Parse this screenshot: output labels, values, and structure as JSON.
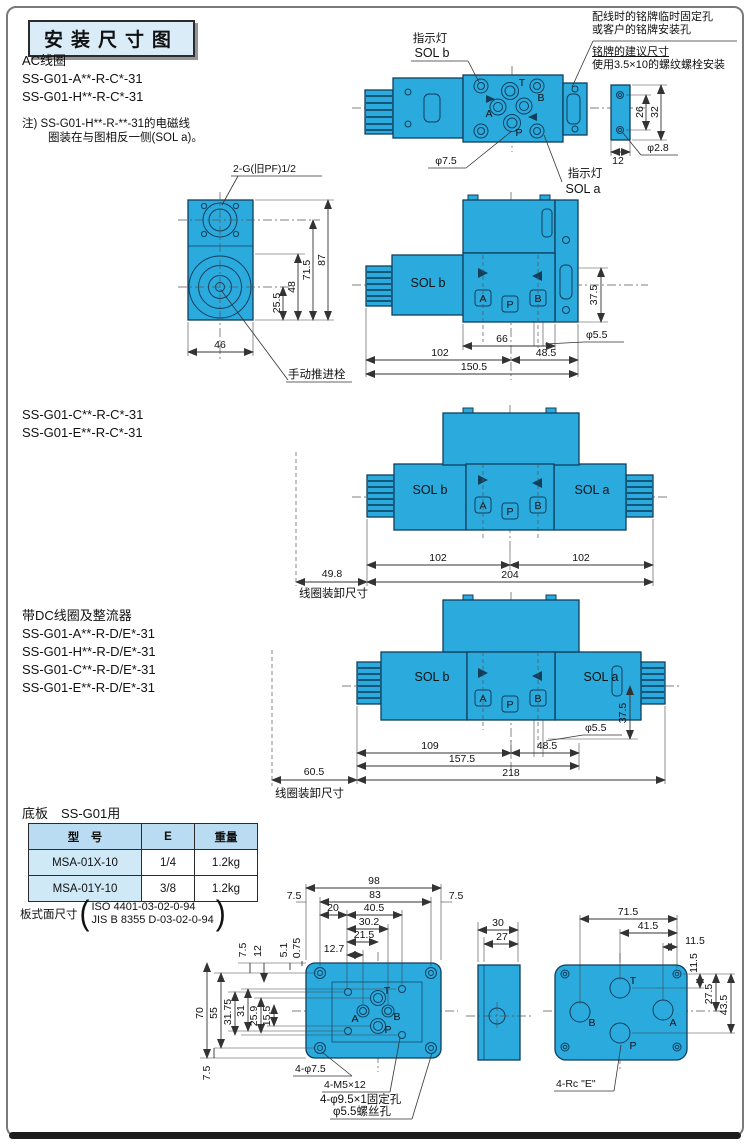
{
  "title": "安装尺寸图",
  "ac": {
    "heading": "AC线圈",
    "m1": "SS-G01-A**-R-C*-31",
    "m2": "SS-G01-H**-R-C*-31",
    "note1": "注) SS-G01-H**-R-**-31的电磁线",
    "note2": "圈装在与图相反一侧(SOL a)。"
  },
  "np": {
    "n1": "配线时的铭牌临时固定孔",
    "n2": "或客户的铭牌安装孔",
    "n3": "铭牌的建议尺寸",
    "n4": "使用3.5×10的螺纹螺栓安装",
    "d26": "26",
    "d32": "32",
    "d12": "12",
    "hole": "φ2.8"
  },
  "plan": {
    "ind_b": "指示灯",
    "solb": "SOL b",
    "ind_a": "指示灯",
    "sola": "SOL a",
    "t": "T",
    "b": "B",
    "a": "A",
    "p": "P",
    "hole": "φ7.5"
  },
  "end": {
    "thread": "2-G(旧PF)1/2",
    "d255": "25.5",
    "d48": "48",
    "d715": "71.5",
    "d87": "87",
    "d46": "46",
    "manual": "手动推进栓"
  },
  "s1": {
    "sol": "SOL b",
    "a": "A",
    "p": "P",
    "b": "B",
    "d375": "37.5",
    "hole": "φ5.5",
    "d66": "66",
    "d102": "102",
    "d485": "48.5",
    "d1505": "150.5"
  },
  "ce": {
    "m1": "SS-G01-C**-R-C*-31",
    "m2": "SS-G01-E**-R-C*-31"
  },
  "s2": {
    "solb": "SOL b",
    "sola": "SOL a",
    "a": "A",
    "p": "P",
    "b": "B",
    "d102l": "102",
    "d102r": "102",
    "d204": "204",
    "d498": "49.8",
    "note": "线圈装卸尺寸"
  },
  "dc": {
    "heading": "带DC线圈及整流器",
    "m1": "SS-G01-A**-R-D/E*-31",
    "m2": "SS-G01-H**-R-D/E*-31",
    "m3": "SS-G01-C**-R-D/E*-31",
    "m4": "SS-G01-E**-R-D/E*-31"
  },
  "s3": {
    "solb": "SOL b",
    "sola": "SOL a",
    "a": "A",
    "p": "P",
    "b": "B",
    "d109": "109",
    "d485": "48.5",
    "hole": "φ5.5",
    "d375": "37.5",
    "d1575": "157.5",
    "d218": "218",
    "d605": "60.5",
    "note": "线圈装卸尺寸"
  },
  "sub": {
    "heading": "底板　SS-G01用",
    "table": {
      "headers": [
        "型　号",
        "E",
        "重量"
      ],
      "rows": [
        [
          "MSA-01X-10",
          "1/4",
          "1.2kg"
        ],
        [
          "MSA-01Y-10",
          "3/8",
          "1.2kg"
        ]
      ]
    },
    "surface": "板式面尺寸",
    "iso": "ISO 4401-03-02-0-94",
    "jis": "JIS B 8355 D-03-02-0-94"
  },
  "f": {
    "d98": "98",
    "d75l": "7.5",
    "d83": "83",
    "d75r": "7.5",
    "d20": "20",
    "d405": "40.5",
    "d302": "30.2",
    "d215": "21.5",
    "d127": "12.7",
    "d75t": "7.5",
    "d12": "12",
    "d51": "5.1",
    "d075": "0.75",
    "d70": "70",
    "d55": "55",
    "d3175": "31.75",
    "d31": "31",
    "d259": "25.9",
    "d155": "15.5",
    "d75b": "7.5",
    "t": "T",
    "a": "A",
    "b": "B",
    "p": "P",
    "n1": "4-φ7.5",
    "n2": "4-M5×12",
    "n3": "4-φ9.5×1固定孔",
    "n4": "φ5.5螺丝孔"
  },
  "sv": {
    "d30": "30",
    "d27": "27"
  },
  "fc": {
    "d715": "71.5",
    "d415": "41.5",
    "d115h": "11.5",
    "d115v": "11.5",
    "d275": "27.5",
    "d435": "43.5",
    "t": "T",
    "b": "B",
    "a": "A",
    "p": "P",
    "note": "4-Rc \"E\""
  }
}
